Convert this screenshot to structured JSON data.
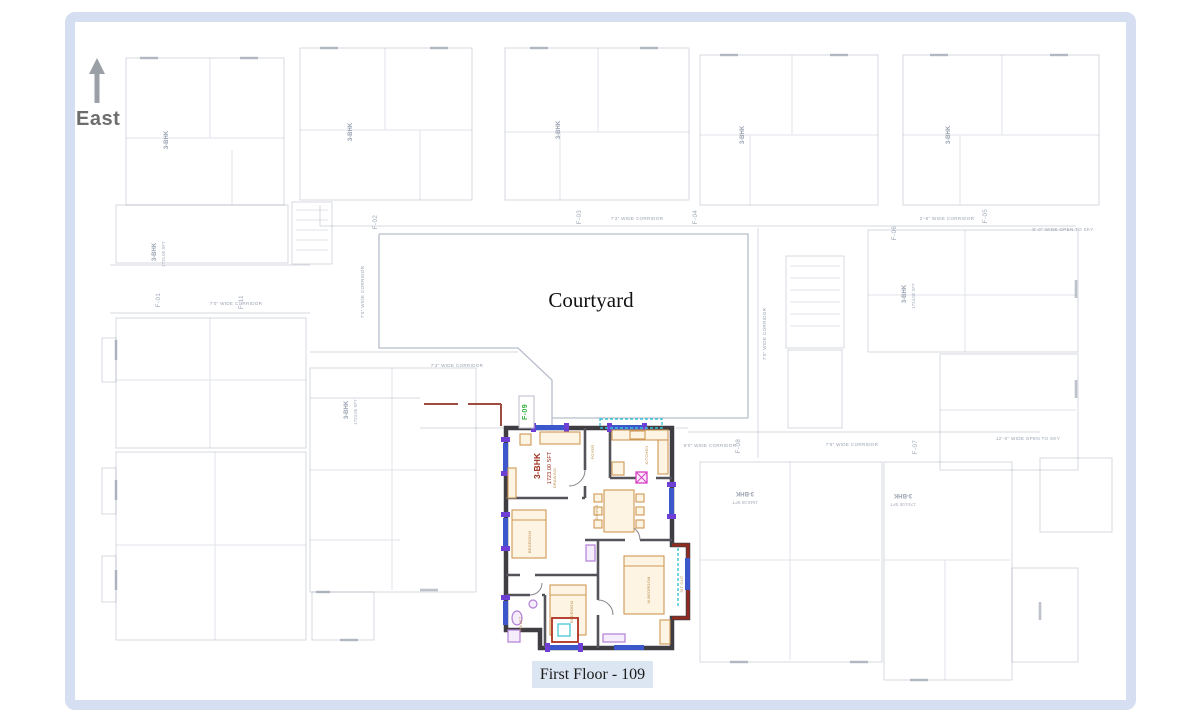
{
  "compass": {
    "label": "East"
  },
  "courtyard": {
    "label": "Courtyard"
  },
  "caption": {
    "label": "First Floor - 109"
  },
  "highlighted_unit": {
    "id": "F-09",
    "type_label": "3-BHK",
    "area_label": "1723.00 SFT"
  },
  "colors": {
    "frame": "#d6dff1",
    "caption-bg": "#dce5f2",
    "faint": "#9aa3b2",
    "wall": "#3f3d42",
    "maroon": "#8f2b20",
    "winblue": "#3c57cc",
    "winpurple": "#6d3fd4",
    "cyan": "#39c2d6",
    "tan": "#cf9752",
    "lavender": "#b07fd6",
    "magenta": "#d63ec4",
    "green": "#2faf3c",
    "redlabel": "#9c2a1a"
  },
  "plan_labels": [
    {
      "t": "7'3\" WIDE CORRIDOR",
      "x": 637,
      "y": 220,
      "r": 0,
      "cls": "corridor"
    },
    {
      "t": "2'-9\" WIDE CORRIDOR",
      "x": 947,
      "y": 220,
      "r": 0,
      "cls": "corridor"
    },
    {
      "t": "8'-0\" WIDE OPEN TO SKY",
      "x": 1063,
      "y": 231,
      "r": 0,
      "cls": "corridor"
    },
    {
      "t": "7'0\" WIDE CORRIDOR",
      "x": 236,
      "y": 305,
      "r": 0,
      "cls": "corridor"
    },
    {
      "t": "7'3\" WIDE CORRIDOR",
      "x": 457,
      "y": 367,
      "r": 0,
      "cls": "corridor"
    },
    {
      "t": "8'0\" WIDE CORRIDOR",
      "x": 710,
      "y": 447,
      "r": 0,
      "cls": "corridor"
    },
    {
      "t": "7'8\" WIDE CORRIDOR",
      "x": 852,
      "y": 446,
      "r": 0,
      "cls": "corridor"
    },
    {
      "t": "12'-0\" WIDE OPEN TO SKY",
      "x": 1028,
      "y": 440,
      "r": 0,
      "cls": "corridor"
    },
    {
      "t": "7'0\" WIDE CORRIDOR",
      "x": 364,
      "y": 292,
      "r": -90,
      "cls": "corridor"
    },
    {
      "t": "7'3\" WIDE CORRIDOR",
      "x": 766,
      "y": 334,
      "r": -90,
      "cls": "corridor"
    },
    {
      "t": "F-01",
      "x": 160,
      "y": 300,
      "r": -90,
      "cls": "unitid"
    },
    {
      "t": "F-11",
      "x": 243,
      "y": 302,
      "r": -90,
      "cls": "unitid"
    },
    {
      "t": "F-02",
      "x": 377,
      "y": 222,
      "r": -90,
      "cls": "unitid"
    },
    {
      "t": "F-03",
      "x": 581,
      "y": 217,
      "r": -90,
      "cls": "unitid"
    },
    {
      "t": "F-04",
      "x": 697,
      "y": 217,
      "r": -90,
      "cls": "unitid"
    },
    {
      "t": "F-05",
      "x": 987,
      "y": 216,
      "r": -90,
      "cls": "unitid"
    },
    {
      "t": "F-06",
      "x": 896,
      "y": 233,
      "r": -90,
      "cls": "unitid"
    },
    {
      "t": "F-08",
      "x": 740,
      "y": 446,
      "r": -90,
      "cls": "unitid"
    },
    {
      "t": "F-07",
      "x": 917,
      "y": 447,
      "r": -90,
      "cls": "unitid"
    },
    {
      "t": "3-BHK",
      "x": 156,
      "y": 252,
      "r": -90,
      "cls": "bhk"
    },
    {
      "t": "1731.00 SFT",
      "x": 165,
      "y": 254,
      "r": -90,
      "cls": "area"
    },
    {
      "t": "3-BHK",
      "x": 348,
      "y": 410,
      "r": -90,
      "cls": "bhk"
    },
    {
      "t": "1723.00 SFT",
      "x": 357,
      "y": 412,
      "r": -90,
      "cls": "area"
    },
    {
      "t": "3-BHK",
      "x": 906,
      "y": 294,
      "r": -90,
      "cls": "bhk"
    },
    {
      "t": "1724.00 SFT",
      "x": 915,
      "y": 296,
      "r": -90,
      "cls": "area"
    },
    {
      "t": "3-BHK",
      "x": 745,
      "y": 492,
      "r": 180,
      "cls": "bhk"
    },
    {
      "t": "1640.00 SFT",
      "x": 745,
      "y": 501,
      "r": 180,
      "cls": "area"
    },
    {
      "t": "3-BHK",
      "x": 903,
      "y": 494,
      "r": 180,
      "cls": "bhk"
    },
    {
      "t": "1744.00 SFT",
      "x": 903,
      "y": 503,
      "r": 180,
      "cls": "area"
    },
    {
      "t": "3-BHK",
      "x": 168,
      "y": 140,
      "r": -90,
      "cls": "bhk"
    },
    {
      "t": "3-BHK",
      "x": 352,
      "y": 132,
      "r": -90,
      "cls": "bhk"
    },
    {
      "t": "3-BHK",
      "x": 560,
      "y": 130,
      "r": -90,
      "cls": "bhk"
    },
    {
      "t": "3-BHK",
      "x": 744,
      "y": 135,
      "r": -90,
      "cls": "bhk"
    },
    {
      "t": "3-BHK",
      "x": 950,
      "y": 135,
      "r": -90,
      "cls": "bhk"
    }
  ],
  "unit_labels": [
    {
      "t": "F-09",
      "x": 527,
      "y": 412,
      "r": -90,
      "cls": "u-id"
    },
    {
      "t": "3-BHK",
      "x": 540,
      "y": 466,
      "r": -90,
      "cls": "u-bhk"
    },
    {
      "t": "1723.00 SFT",
      "x": 551,
      "y": 468,
      "r": -90,
      "cls": "u-area"
    },
    {
      "t": "DRAWING",
      "x": 556,
      "y": 478,
      "r": -90,
      "cls": "u-room"
    },
    {
      "t": "FOYER",
      "x": 594,
      "y": 452,
      "r": -90,
      "cls": "u-room"
    },
    {
      "t": "KITCHEN",
      "x": 648,
      "y": 455,
      "r": -90,
      "cls": "u-room"
    },
    {
      "t": "DINING",
      "x": 598,
      "y": 512,
      "r": -90,
      "cls": "u-room"
    },
    {
      "t": "BEDROOM",
      "x": 531,
      "y": 542,
      "r": -90,
      "cls": "u-room"
    },
    {
      "t": "M.BEDROOM",
      "x": 650,
      "y": 590,
      "r": -90,
      "cls": "u-room"
    },
    {
      "t": "BEDROOM",
      "x": 573,
      "y": 612,
      "r": -90,
      "cls": "u-room"
    },
    {
      "t": "TOILET",
      "x": 522,
      "y": 624,
      "r": -90,
      "cls": "u-room"
    },
    {
      "t": "SIT OUT",
      "x": 683,
      "y": 584,
      "r": -90,
      "cls": "u-room"
    }
  ]
}
